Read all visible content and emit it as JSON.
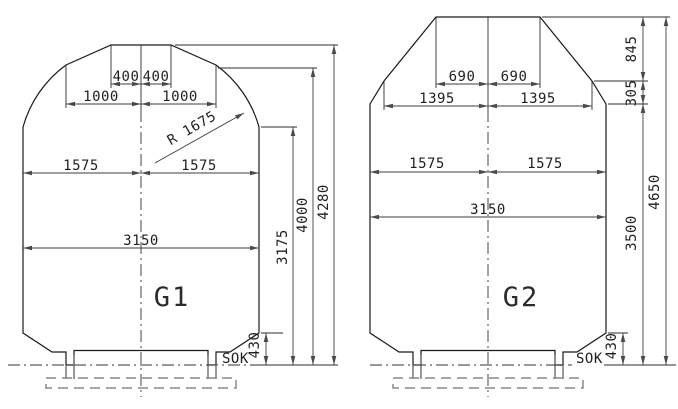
{
  "drawing": {
    "g1": {
      "name": "G1",
      "sok": "SOK",
      "radius_label": "R 1675",
      "dim_400_left": "400",
      "dim_400_right": "400",
      "dim_1000_left": "1000",
      "dim_1000_right": "1000",
      "dim_1575_left": "1575",
      "dim_1575_right": "1575",
      "dim_3150": "3150",
      "dim_3175": "3175",
      "dim_4000": "4000",
      "dim_4280": "4280",
      "dim_430": "430"
    },
    "g2": {
      "name": "G2",
      "sok": "SOK",
      "dim_690_left": "690",
      "dim_690_right": "690",
      "dim_1395_left": "1395",
      "dim_1395_right": "1395",
      "dim_1575_left": "1575",
      "dim_1575_right": "1575",
      "dim_3150": "3150",
      "dim_845": "845",
      "dim_305": "305",
      "dim_3500": "3500",
      "dim_4650": "4650",
      "dim_430": "430"
    }
  }
}
